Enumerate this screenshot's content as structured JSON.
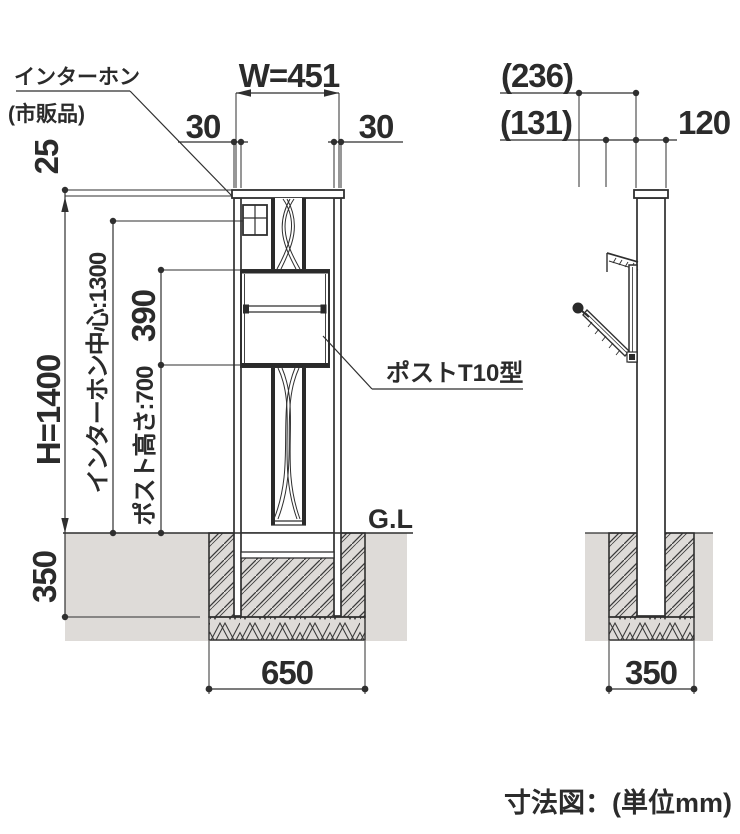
{
  "colors": {
    "line": "#2f2f2f",
    "ground": "#dedbd8"
  },
  "front_view": {
    "width_label": "W=451",
    "post_width_left": "30",
    "post_width_right": "30",
    "cap_height": "25",
    "total_height": "H=1400",
    "intercom_center_height": "インターホン中心:1300",
    "post_box_height": "390",
    "post_mount_height": "ポスト高さ:700",
    "embed_depth": "350",
    "foundation_width": "650",
    "ground_level": "G.L"
  },
  "side_view": {
    "open_flap_depth": "(236)",
    "door_swing_depth": "(131)",
    "post_depth": "120",
    "foundation_width": "350"
  },
  "callouts": {
    "intercom_line1": "インターホン",
    "intercom_line2": "(市販品)",
    "post_model": "ポストT10型"
  },
  "caption": "寸法図：(単位mm)"
}
